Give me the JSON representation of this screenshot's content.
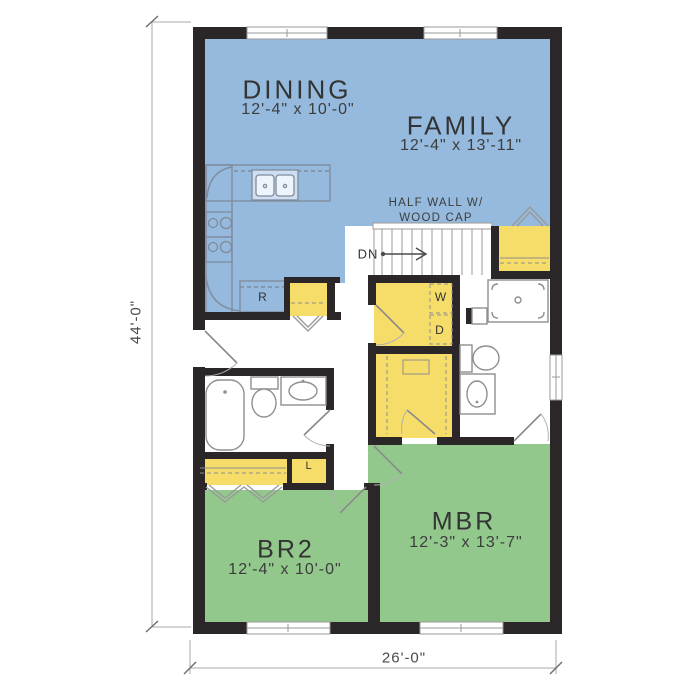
{
  "plan_labels": {
    "half_wall_line1": "HALF WALL W/",
    "half_wall_line2": "WOOD CAP",
    "stairs_down": "DN",
    "refrigerator": "R",
    "washer": "W",
    "dryer": "D",
    "linen_closet": "L"
  },
  "rooms": [
    {
      "name": "DINING",
      "dims": "12'-4\" x 10'-0\""
    },
    {
      "name": "FAMILY",
      "dims": "12'-4\" x 13'-11\""
    },
    {
      "name": "BR2",
      "dims": "12'-4\" x 10'-0\""
    },
    {
      "name": "MBR",
      "dims": "12'-3\" x 13'-7\""
    }
  ],
  "dimensions": {
    "overall_depth": "44'-0\"",
    "overall_width": "26'-0\""
  },
  "colors": {
    "living_area": "#95badd",
    "bedroom_area": "#92c88c",
    "closet_area": "#f6dd69",
    "wall": "#2b2627"
  }
}
